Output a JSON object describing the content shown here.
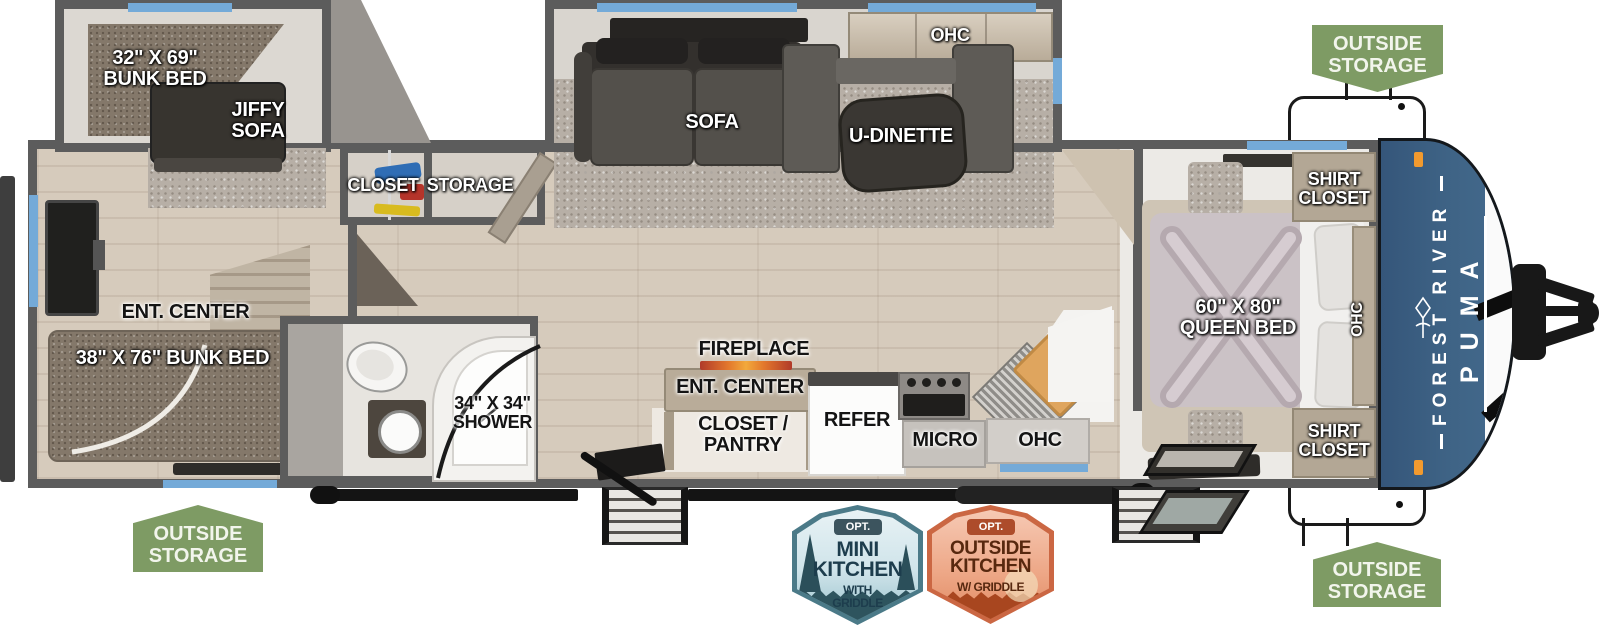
{
  "floorplan": {
    "rear_slide": {
      "bunk_bed": "32\" X 69\"\nBUNK BED",
      "jiffy_sofa": "JIFFY\nSOFA"
    },
    "closet": "CLOSET",
    "storage": "STORAGE",
    "rear_room": {
      "ent_center": "ENT. CENTER",
      "bunk_bed": "38\" X 76\" BUNK BED"
    },
    "bathroom": {
      "shower": "34\" X 34\"\nSHOWER"
    },
    "living_slide": {
      "sofa": "SOFA",
      "u_dinette": "U-DINETTE",
      "ohc": "OHC"
    },
    "kitchen": {
      "fireplace": "FIREPLACE",
      "ent_center": "ENT. CENTER",
      "closet_pantry": "CLOSET /\nPANTRY",
      "refer": "REFER",
      "micro": "MICRO",
      "ohc": "OHC"
    },
    "bedroom": {
      "shirt_closet_top": "SHIRT\nCLOSET",
      "queen_bed": "60\" X 80\"\nQUEEN BED",
      "ohc": "OHC",
      "shirt_closet_bottom": "SHIRT\nCLOSET"
    }
  },
  "exterior": {
    "brand": {
      "maker": "FOREST RIVER",
      "model": "PUMA"
    },
    "outside_storage": "OUTSIDE\nSTORAGE"
  },
  "badges": {
    "mini_kitchen": {
      "opt": "OPT.",
      "title": "MINI\nKITCHEN",
      "subtitle": "WITH\nGRIDDLE"
    },
    "outside_kitchen": {
      "opt": "OPT.",
      "title": "OUTSIDE\nKITCHEN",
      "subtitle": "W/ GRIDDLE"
    }
  },
  "colors": {
    "wall_gray": "#5C5C5C",
    "window_blue": "#74AAD8",
    "cap_blue": "#3C5F81",
    "green_badge": "#7E9B64",
    "mini_badge_teal": "#4B7A88",
    "outside_badge_orange": "#CB6743",
    "flame_orange": "#F29A2E",
    "wood_floor": "#D6CBBC"
  }
}
